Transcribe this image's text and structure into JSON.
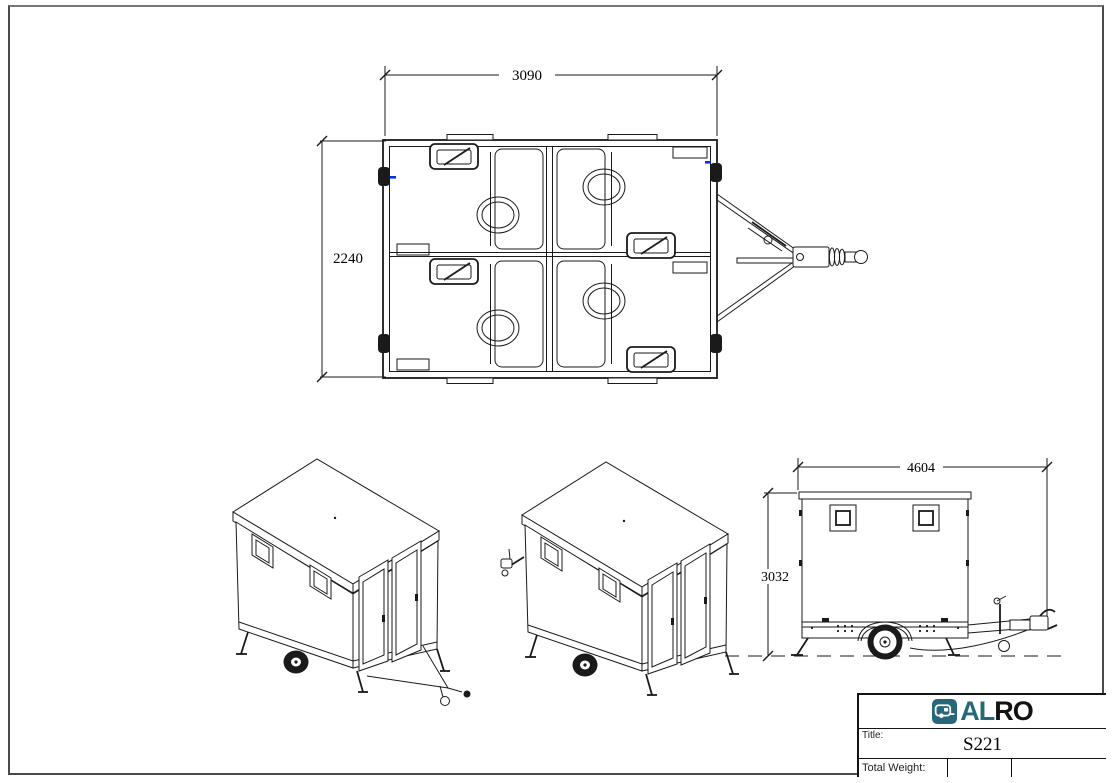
{
  "dimensions": {
    "top_view_width": "3090",
    "top_view_height": "2240",
    "side_view_length": "4604",
    "side_view_height": "3032"
  },
  "title_block": {
    "brand_al": "AL",
    "brand_ro": "RO",
    "title_label": "Title:",
    "title_value": "S221",
    "total_weight_label": "Total Weight:",
    "total_weight_value": "",
    "extra_cell_value": ""
  },
  "icons": {
    "logo_icon": "caravan-icon"
  },
  "colors": {
    "brand_teal": "#266878",
    "line_color": "#1a1a1a",
    "marker_blue": "#0033ee"
  }
}
